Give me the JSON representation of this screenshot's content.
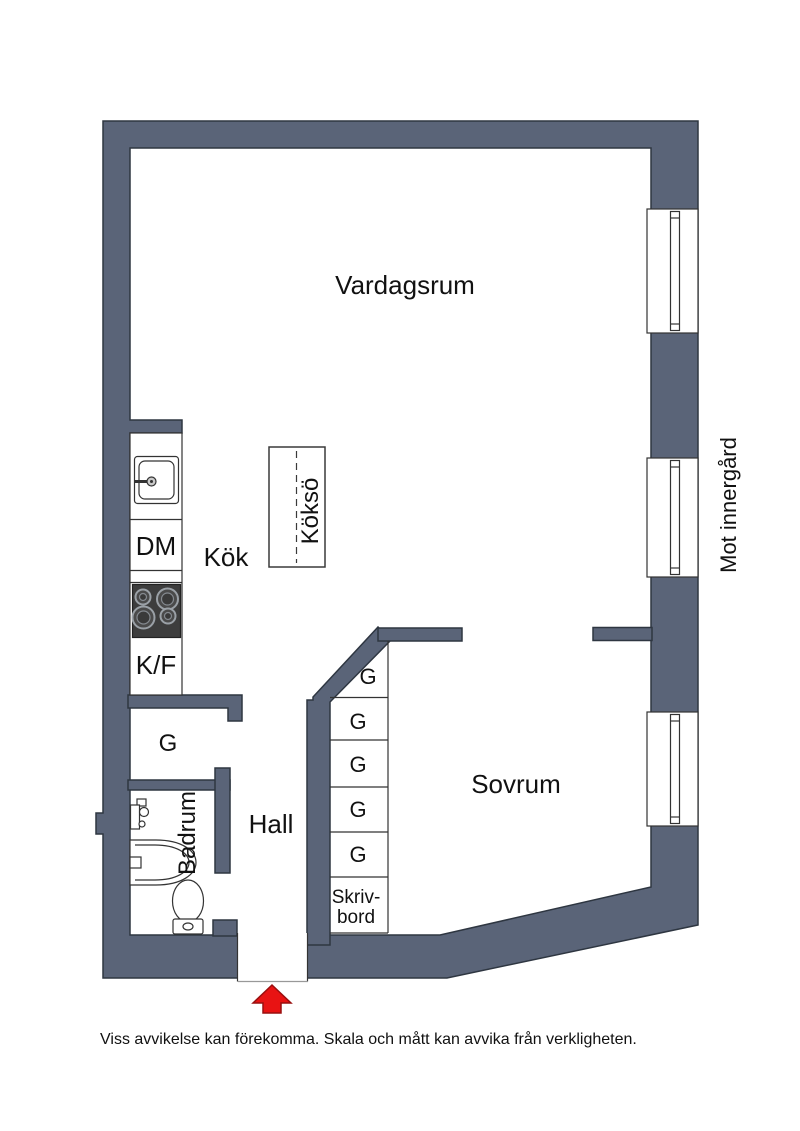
{
  "plan": {
    "rooms": {
      "living_room": "Vardagsrum",
      "kitchen": "Kök",
      "kitchen_island": "Köksö",
      "bedroom": "Sovrum",
      "hall": "Hall",
      "bathroom": "Badrum",
      "closet_room": "G"
    },
    "kitchen_units": {
      "dishwasher": "DM",
      "fridge_freezer": "K/F"
    },
    "closet_cells": [
      "G",
      "G",
      "G",
      "G",
      "G"
    ],
    "desk": {
      "line1": "Skriv-",
      "line2": "bord"
    },
    "facade_note": "Mot innergård",
    "disclaimer": "Viss avvikelse kan förekomma. Skala och mått kan avvika från verkligheten."
  },
  "colors": {
    "wall": "#5a6478",
    "wall_outline": "#2e3641",
    "line": "#333333",
    "threshold": "#999999",
    "arrow": "#e81313",
    "arrow_outline": "#990f0f",
    "stove": "#3d3d3d",
    "burner_ring": "#9aa0a6",
    "burner_fill": "#4a4a4a"
  }
}
